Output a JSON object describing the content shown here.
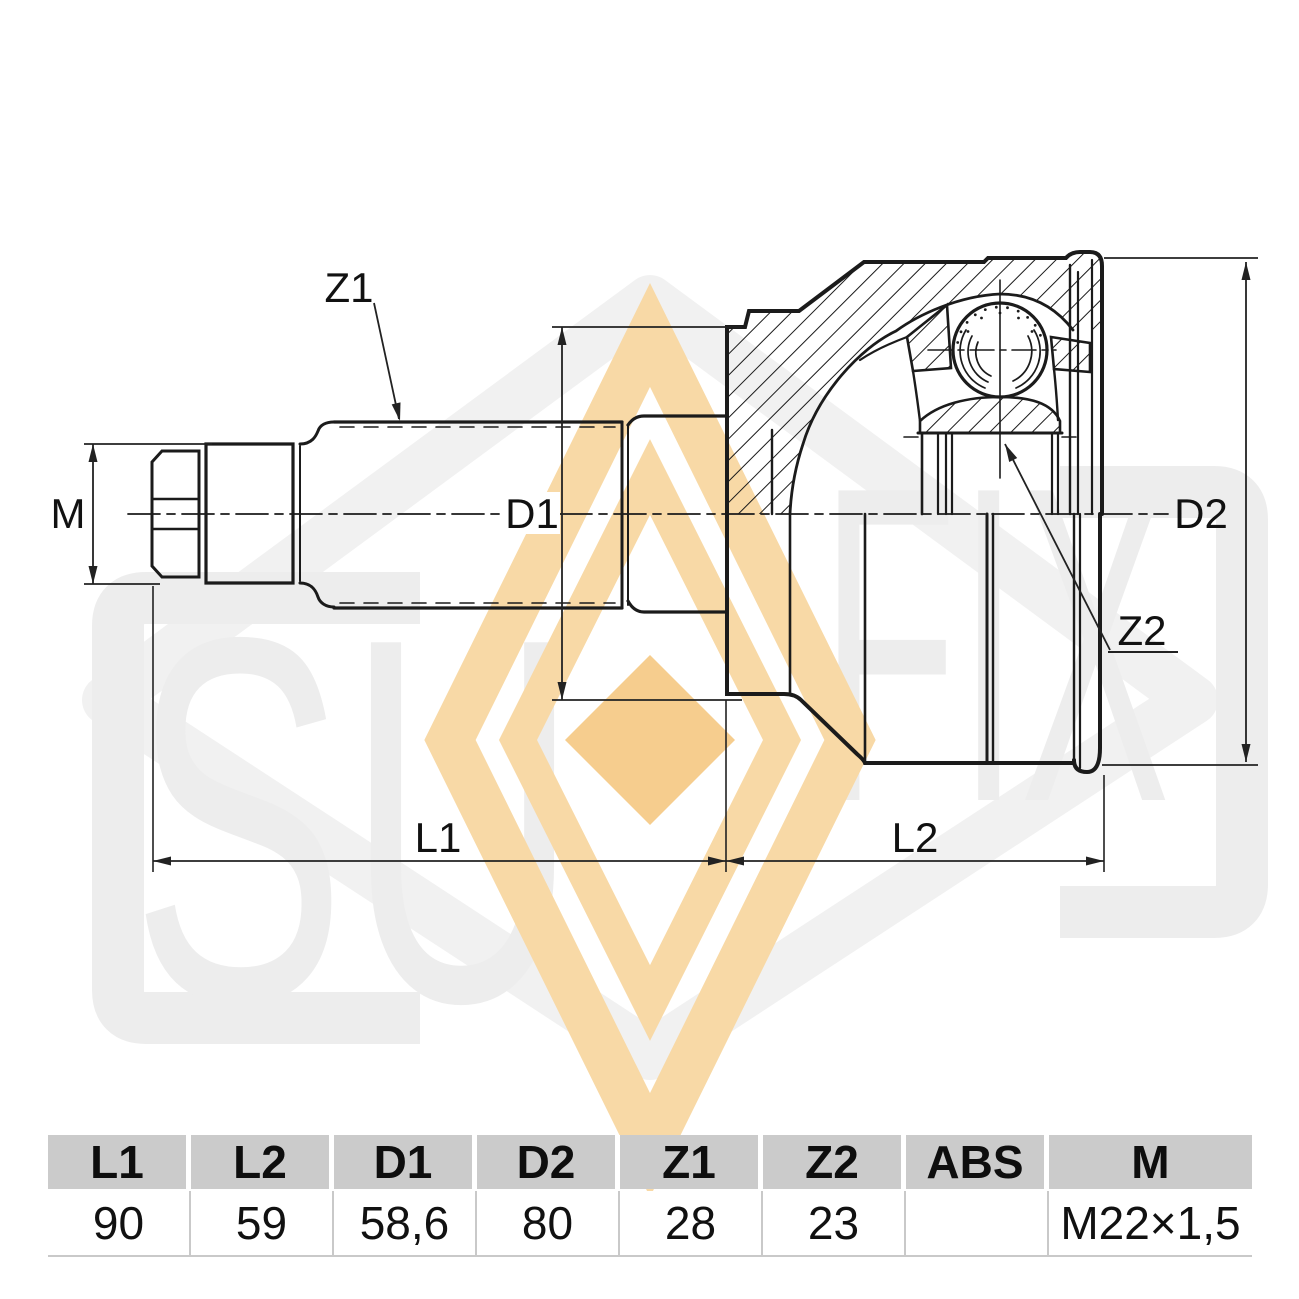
{
  "watermark": {
    "text_left": "SU",
    "text_right": "FIX",
    "gray": "#ededed",
    "band_color": "#f8d9a6",
    "solid_color": "#f6cd8e"
  },
  "drawing": {
    "labels": {
      "z1": "Z1",
      "z2": "Z2",
      "d1": "D1",
      "d2": "D2",
      "m": "M",
      "l1": "L1",
      "l2": "L2"
    }
  },
  "table": {
    "columns": [
      {
        "label": "L1",
        "value": "90"
      },
      {
        "label": "L2",
        "value": "59"
      },
      {
        "label": "D1",
        "value": "58,6"
      },
      {
        "label": "D2",
        "value": "80"
      },
      {
        "label": "Z1",
        "value": "28"
      },
      {
        "label": "Z2",
        "value": "23"
      },
      {
        "label": "ABS",
        "value": ""
      },
      {
        "label": "M",
        "value": "M22×1,5"
      }
    ]
  }
}
